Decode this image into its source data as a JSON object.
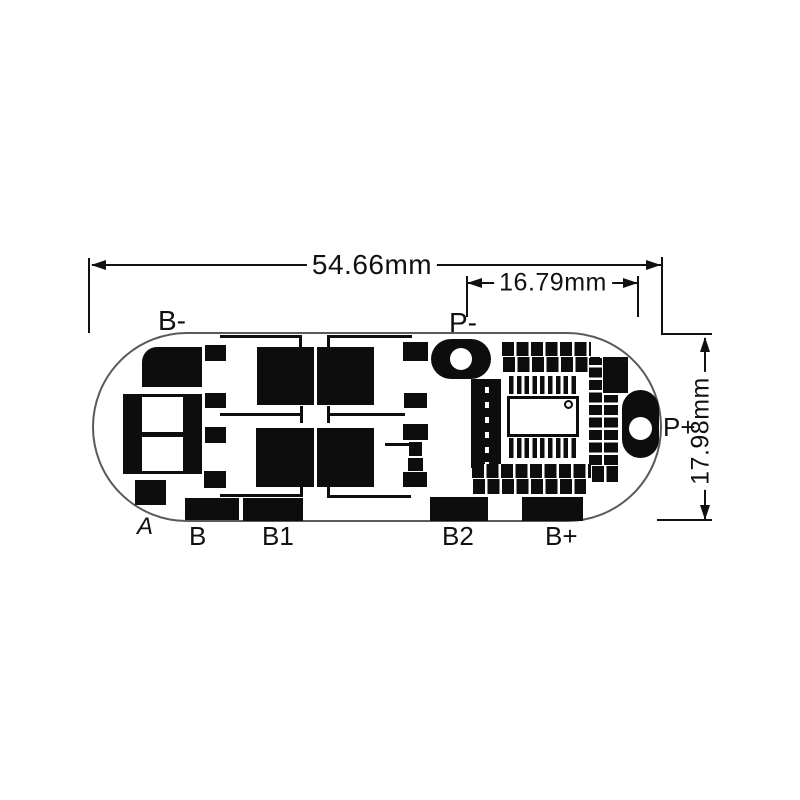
{
  "dimensions": {
    "board_width": "54.66mm",
    "hole_spacing": "16.79mm",
    "board_height": "17.98mm"
  },
  "pad_labels": {
    "b_minus": "B-",
    "p_minus": "P-",
    "p_plus": "P+",
    "a": "A",
    "b": "B",
    "b1": "B1",
    "b2": "B2",
    "b_plus": "B+"
  },
  "colors": {
    "ink": "#111111",
    "silkscreen": "#0d0d0d",
    "board_outline": "#5a5a5a",
    "background": "#ffffff"
  }
}
